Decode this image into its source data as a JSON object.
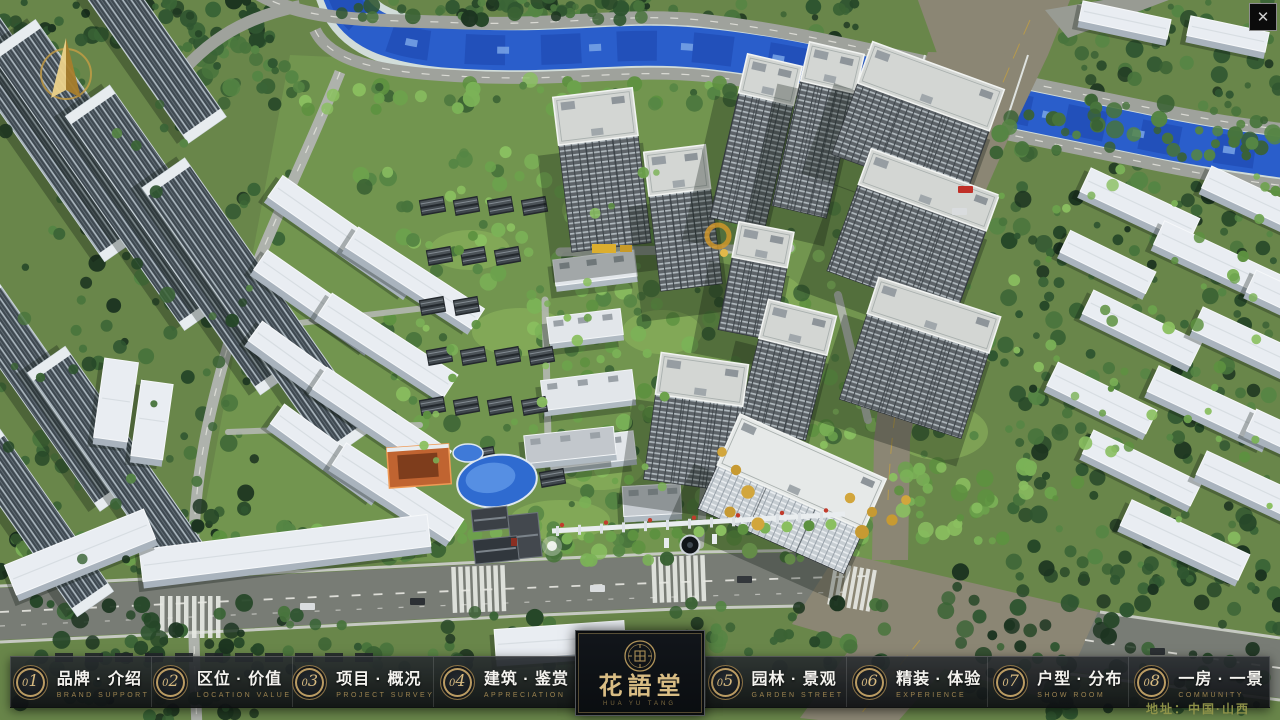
{
  "window": {
    "close_icon": "✕"
  },
  "nav": {
    "items": [
      {
        "num": "01",
        "label": "品牌 · 介绍",
        "sub": "BRAND SUPPORT"
      },
      {
        "num": "02",
        "label": "区位 · 价值",
        "sub": "LOCATION VALUE"
      },
      {
        "num": "03",
        "label": "项目 · 概况",
        "sub": "PROJECT SURVEY"
      },
      {
        "num": "04",
        "label": "建筑 · 鉴赏",
        "sub": "APPRECIATION"
      },
      {
        "num": "05",
        "label": "园林 · 景观",
        "sub": "GARDEN STREET"
      },
      {
        "num": "06",
        "label": "精装 · 体验",
        "sub": "EXPERIENCE"
      },
      {
        "num": "07",
        "label": "户型 · 分布",
        "sub": "SHOW ROOM"
      },
      {
        "num": "08",
        "label": "一房 · 一景",
        "sub": "COMMUNITY"
      }
    ]
  },
  "logo": {
    "name": "花語堂",
    "caption": "HUA YU TANG"
  },
  "footer": {
    "address": "地址：中国·山西"
  },
  "colors": {
    "gold": "#c2a269",
    "bar_bg": "#14171b",
    "label_white": "#f4f3ef",
    "sub_gold": "#9c8350",
    "address_olive": "#93964a",
    "river_blue": "#2a5ecb"
  }
}
